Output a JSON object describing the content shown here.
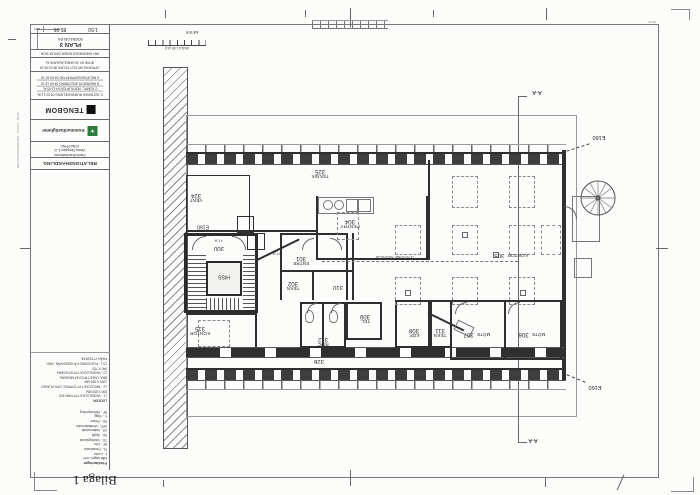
{
  "page": {
    "stamp": "Bilaga 1"
  },
  "titleblock": {
    "scale_label": "SKALA",
    "scale": "1:50",
    "number_label": "NUMMER",
    "number": "85.05",
    "bet_label": "BET",
    "plan_title": "PLAN 3",
    "plan_subtitle": "SÖDRA DELEN",
    "rev_header": "ANT   ÄNDRINGEN AVSER   DATUM   SIGN",
    "revisions": [
      "D  JUSTERAD RUMSINDELNING  05-02-12  AL",
      "C  KOMPL. VENTILATION  04-11-05  AL",
      "B  ÄNDRAD PLANLÖSNING  04-06-18  JS",
      "A  RELATIONSUPPRÄTTAD  04-03-02  JS"
    ],
    "meta1": "UPPDRAG NR 2017-03    DATUM 03-09-18",
    "meta2": "RITAD AV JS    HANDLÄGGARE AL",
    "logo_tengbom": "TENGBOM",
    "logo_client": "Kommunfastigheter",
    "address": [
      "Gamla Brandstationen",
      "Västra Storgatan 3-12",
      "JÖNKÖPING"
    ],
    "status": "RELATIONSHANDLING",
    "micro_corner": "85-05",
    "micro_margin": "RELATIONSHANDLING · PLAN 3 · 85.05"
  },
  "notes": {
    "title": "LUCKOR",
    "lines": [
      "L1 - VINDSLUCKA TYP RNM 870",
      "600 X 600 MM",
      "L2 - TAKLUCKA TYP GYPROC GPG PLANEX",
      "1200 X 600 MM",
      "BRA 1 MED TRYCKSTÄNGNING",
      "L3 - VINDSLUCKA TYP BYGGBRA",
      "940 X 750",
      "L5:1 - PLACERING PÅ NEDERVÅN. VIND",
      "FRÅN YTTERTAK"
    ]
  },
  "legend": {
    "title": "Förklaringar",
    "note": "Mått anges i mm",
    "items": [
      "L - Lucka",
      "FL - Fasadlucka",
      "DF - Dörr",
      "TD - Vädringslucka",
      "SD - Spjäll",
      "VS - Vattenschakt",
      "VPD - Ventilationsdon",
      "PD - Pelare",
      "V - Vägg",
      "NF - Nödutrymning"
    ]
  },
  "scalebar": {
    "meter": "METER",
    "caption": "SKALA 1:50 (A1)"
  },
  "section": {
    "label": "A-A"
  },
  "plan": {
    "lift": "HISS",
    "e160": "E160",
    "level": "+7,4",
    "annotation": "+5,70 UK BEF. TAKSTOLAR",
    "rooms": [
      {
        "name": "VENT",
        "num": "324"
      },
      {
        "name": "TEKNIK",
        "num": "325"
      },
      {
        "name": "PENTRY",
        "num": "304"
      },
      {
        "name": "",
        "num": "300"
      },
      {
        "name": "ENTRE",
        "num": "301"
      },
      {
        "name": "TEKN",
        "num": "302"
      },
      {
        "name": "",
        "num": "310"
      },
      {
        "name": "TEL.",
        "num": "309"
      },
      {
        "name": "RWC",
        "num": "312"
      },
      {
        "name": "KÖP.",
        "num": "308"
      },
      {
        "name": "TEKN",
        "num": "311"
      },
      {
        "name": "MÖTE",
        "num": "307"
      },
      {
        "name": "MÖTE",
        "num": "306"
      },
      {
        "name": "KONTOR",
        "num": "305"
      },
      {
        "name": "KONTOR",
        "num": "315"
      },
      {
        "name": "",
        "num": "326"
      }
    ]
  }
}
